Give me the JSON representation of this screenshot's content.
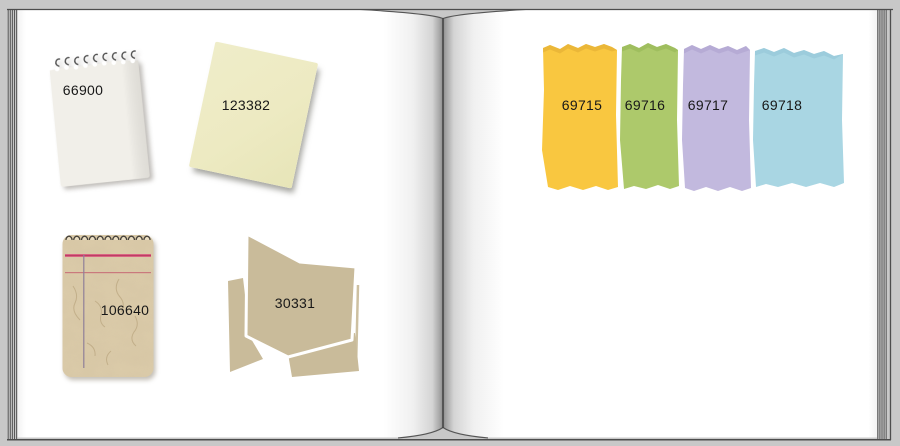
{
  "app": {
    "description": "Open scrapbook album with paper scrap elements",
    "background_color": "#c8c8c8",
    "page_color": "#ffffff",
    "spine_color": "#3e3e3e"
  },
  "left_page": {
    "items": [
      {
        "id": "white-spiral-notepad",
        "type": "spiral-notepad",
        "label": "66900",
        "color": "#f1efe9",
        "hook_color": "#4f4f4f"
      },
      {
        "id": "yellow-note",
        "type": "paper-note",
        "label": "123382",
        "color": "#edeac2"
      },
      {
        "id": "kraft-spiral-notepad",
        "type": "spiral-notepad",
        "label": "106640",
        "color": "#dbcba9",
        "line_color": "#d95f80",
        "thin_line_color": "#c76b76",
        "margin_line_color": "#8f7f98"
      },
      {
        "id": "folded-paper",
        "type": "folded-paper",
        "label": "30331",
        "color": "#c9bb9a",
        "outline_color": "#cdc0a1"
      }
    ]
  },
  "right_page": {
    "strips": [
      {
        "id": "strip-yellow",
        "label": "69715",
        "color": "#f9c740",
        "edge_color": "#d9a52e"
      },
      {
        "id": "strip-green",
        "label": "69716",
        "color": "#adc96b",
        "edge_color": "#8fb250"
      },
      {
        "id": "strip-lavender",
        "label": "69717",
        "color": "#c2b9de",
        "edge_color": "#a89cca"
      },
      {
        "id": "strip-blue",
        "label": "69718",
        "color": "#a9d6e3",
        "edge_color": "#8cc2d2"
      }
    ]
  }
}
